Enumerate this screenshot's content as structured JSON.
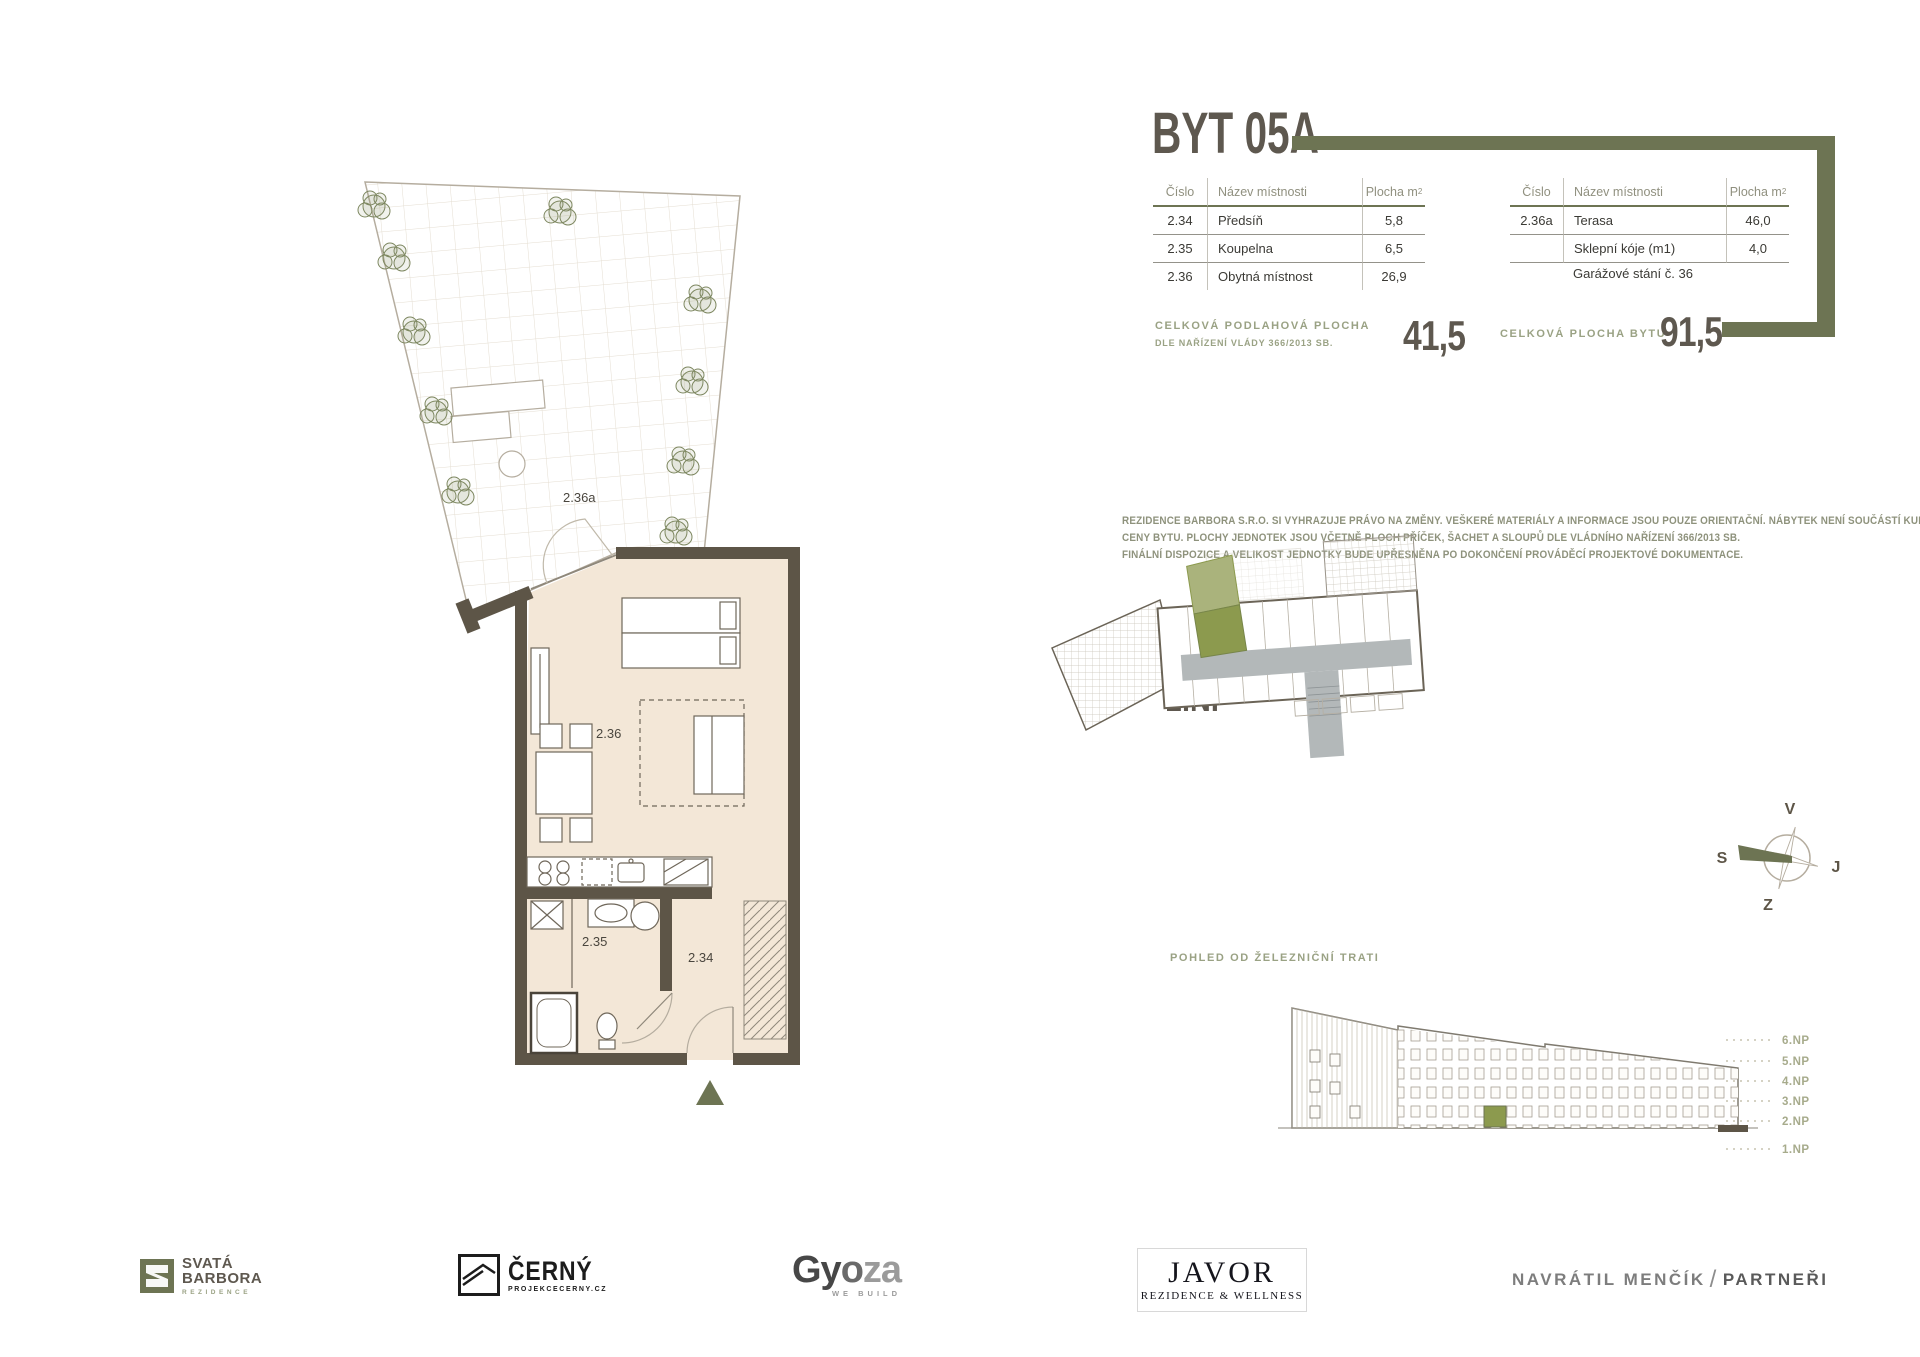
{
  "title": "BYT 05A",
  "colors": {
    "accent_olive": "#6d7453",
    "ink_taupe": "#5e584f",
    "label_olive": "#9aa284",
    "wall": "#5d5547",
    "floor_beige": "#f3e7d7",
    "unit_green": "#8c9a4e",
    "corridor_gray": "#b3b8b9"
  },
  "room_table_1": {
    "col_num": "Číslo",
    "col_name": "Název místnosti",
    "col_area": "Plocha m",
    "col_area_sup": "2",
    "rows": [
      {
        "num": "2.34",
        "name": "Předsíň",
        "area": "5,8"
      },
      {
        "num": "2.35",
        "name": "Koupelna",
        "area": "6,5"
      },
      {
        "num": "2.36",
        "name": "Obytná místnost",
        "area": "26,9"
      }
    ]
  },
  "room_table_2": {
    "col_num": "Číslo",
    "col_name": "Název místnosti",
    "col_area": "Plocha m",
    "col_area_sup": "2",
    "rows": [
      {
        "num": "2.36a",
        "name": "Terasa",
        "area": "46,0"
      },
      {
        "num": "",
        "name": "Sklepní kóje (m1)",
        "area": "4,0"
      }
    ],
    "note": "Garážové stání č. 36"
  },
  "totals": {
    "floor_label": "CELKOVÁ PODLAHOVÁ PLOCHA",
    "floor_sublabel": "DLE NAŘÍZENÍ VLÁDY 366/2013 SB.",
    "floor_value": "41,5",
    "total_label": "CELKOVÁ PLOCHA BYTU",
    "total_value": "91,5"
  },
  "disclaimer": {
    "line1": "REZIDENCE BARBORA S.R.O. SI VYHRAZUJE PRÁVO NA ZMĚNY. VEŠKERÉ MATERIÁLY A INFORMACE JSOU POUZE ORIENTAČNÍ. NÁBYTEK NENÍ SOUČÁSTÍ KUPNÍ",
    "line2": "CENY BYTU. PLOCHY JEDNOTEK JSOU VČETNĚ PLOCH PŘÍČEK, ŠACHET A SLOUPŮ DLE VLÁDNÍHO NAŘÍZENÍ 366/2013 SB.",
    "line3": "FINÁLNÍ DISPOZICE A VELIKOST JEDNOTKY BUDE UPŘESNĚNA PO DOKONČENÍ PROVÁDĚCÍ PROJEKTOVÉ DOKUMENTACE."
  },
  "floor_plan": {
    "labels": {
      "terrace": "2.36a",
      "living": "2.36",
      "bath": "2.35",
      "hall": "2.34"
    }
  },
  "site_plan": {
    "label": "PŮDORYS",
    "floor": "2.NP",
    "compass": {
      "top": "V",
      "right": "J",
      "bottom": "Z",
      "left": "S"
    }
  },
  "elevation": {
    "label": "POHLED OD ŽELEZNIČNÍ TRATI",
    "levels": [
      "6.NP",
      "5.NP",
      "4.NP",
      "3.NP",
      "2.NP",
      "1.NP"
    ]
  },
  "footer": {
    "svata": {
      "line1": "SVATÁ",
      "line2": "BARBORA",
      "sub": "REZIDENCE"
    },
    "cerny": {
      "name": "ČERNÝ",
      "sub": "PROJEKCECERNY.CZ"
    },
    "gyoza": {
      "part1": "Gy",
      "part2": "o",
      "part3": "za",
      "sub": "WE BUILD"
    },
    "javor": {
      "name": "JAVOR",
      "sub": "REZIDENCE & WELLNESS"
    },
    "navratil": {
      "name": "NAVRÁTIL MENČÍK",
      "slash": "/",
      "partner": "PARTNEŘI"
    }
  }
}
